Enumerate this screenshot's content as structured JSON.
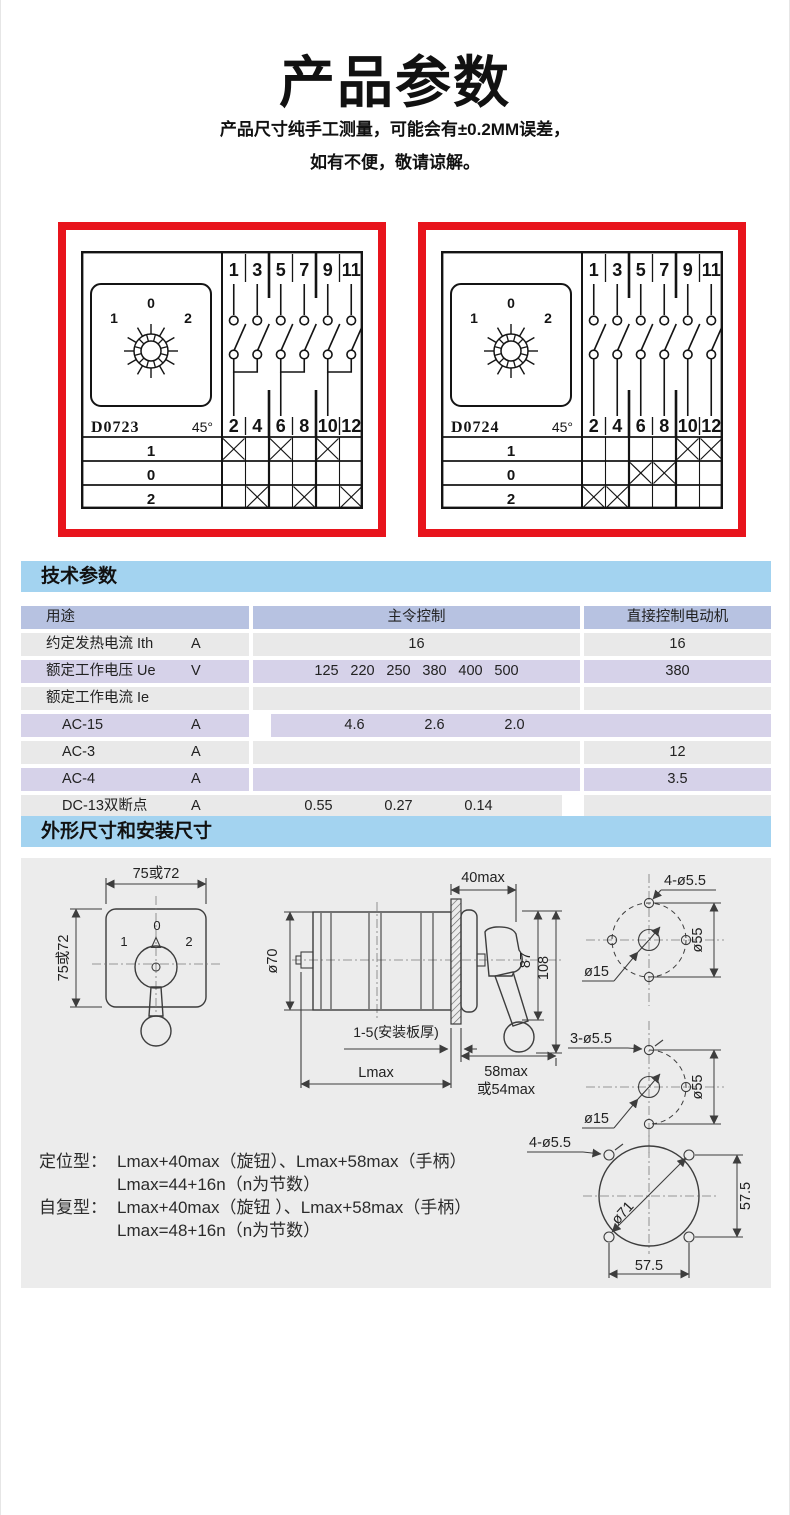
{
  "colors": {
    "red": "#e8141c",
    "strip": "#a3d3f0",
    "hdr": "#b7c2e1",
    "lav": "#d6d2e9",
    "gry": "#e9e9e9",
    "canvas": "#ececec"
  },
  "header": {
    "title": "产品参数",
    "subtitle1": "产品尺寸纯手工测量，可能会有±0.2MM误差，",
    "subtitle2": "如有不便，敬请谅解。"
  },
  "sections": {
    "tech": "技术参数",
    "dims": "外形尺寸和安装尺寸"
  },
  "diagrams": [
    {
      "model": "D0723",
      "angle": "45°",
      "knob_labels": [
        "1",
        "0",
        "2"
      ],
      "positions": [
        "1",
        "0",
        "2"
      ],
      "top_terminals": [
        "1",
        "3",
        "5",
        "7",
        "9",
        "11"
      ],
      "bottom_terminals": [
        "2",
        "4",
        "6",
        "8",
        "10",
        "12"
      ],
      "paired_contacts": true,
      "crosses": [
        [
          "2",
          "6",
          "10"
        ],
        [],
        [
          "4",
          "8",
          "12"
        ]
      ]
    },
    {
      "model": "D0724",
      "angle": "45°",
      "knob_labels": [
        "1",
        "0",
        "2"
      ],
      "positions": [
        "1",
        "0",
        "2"
      ],
      "top_terminals": [
        "1",
        "3",
        "5",
        "7",
        "9",
        "11"
      ],
      "bottom_terminals": [
        "2",
        "4",
        "6",
        "8",
        "10",
        "12"
      ],
      "paired_contacts": false,
      "crosses": [
        [
          "10",
          "12"
        ],
        [
          "6",
          "8"
        ],
        [
          "2",
          "4"
        ]
      ]
    }
  ],
  "spec_table": {
    "columns": {
      "usage": "用途",
      "master": "主令控制",
      "motor": "直接控制电动机"
    },
    "rows": [
      {
        "label": "约定发热电流 Ith",
        "unit": "A",
        "indent": false,
        "master": [
          "16"
        ],
        "motor": "16"
      },
      {
        "label": "额定工作电压 Ue",
        "unit": "V",
        "indent": false,
        "master": [
          "125",
          "220",
          "250",
          "380",
          "400",
          "500"
        ],
        "motor": "380"
      },
      {
        "label": "额定工作电流 Ie",
        "unit": "",
        "indent": false,
        "master": [],
        "motor": ""
      },
      {
        "label": "AC-15",
        "unit": "A",
        "indent": true,
        "master": [
          "4.6",
          "2.6",
          "2.0"
        ],
        "motor": ""
      },
      {
        "label": "AC-3",
        "unit": "A",
        "indent": true,
        "master": [],
        "motor": "12"
      },
      {
        "label": "AC-4",
        "unit": "A",
        "indent": true,
        "master": [],
        "motor": "3.5"
      },
      {
        "label": "DC-13双断点",
        "unit": "A",
        "indent": true,
        "master": [
          "0.55",
          "0.27",
          "0.14"
        ],
        "motor": ""
      },
      {
        "label": "DC-13四断点",
        "unit": "A",
        "indent": true,
        "master": [
          "0.82",
          "0.41",
          "0.20"
        ],
        "motor": ""
      }
    ]
  },
  "drawings": {
    "front": {
      "width_label": "75或72",
      "height_label": "75或72",
      "positions": [
        "1",
        "0",
        "2"
      ]
    },
    "side": {
      "body_dia": "ø70",
      "depth": "40max",
      "handle_h": "87",
      "total_h": "108",
      "plate": "1-5(安装板厚)",
      "length": "Lmax",
      "knob_depth_1": "58max",
      "knob_depth_2": "或54max"
    },
    "holes4": {
      "holes": "4-ø5.5",
      "center_hole": "ø15",
      "bolt_circle": "ø55"
    },
    "holes3": {
      "holes": "3-ø5.5",
      "center_hole": "ø15",
      "bolt_circle": "ø55"
    },
    "panel": {
      "holes": "4-ø5.5",
      "cutout": "ø71",
      "spacing_v": "57.5",
      "spacing_h": "57.5"
    },
    "notes": [
      {
        "label": "定位型：",
        "text": "Lmax+40max（旋钮）、Lmax+58max（手柄）"
      },
      {
        "label": "",
        "text": "Lmax=44+16n（n为节数）"
      },
      {
        "label": "自复型：",
        "text": "Lmax+40max（旋钮 ）、Lmax+58max（手柄）"
      },
      {
        "label": "",
        "text": "Lmax=48+16n（n为节数）"
      }
    ]
  }
}
